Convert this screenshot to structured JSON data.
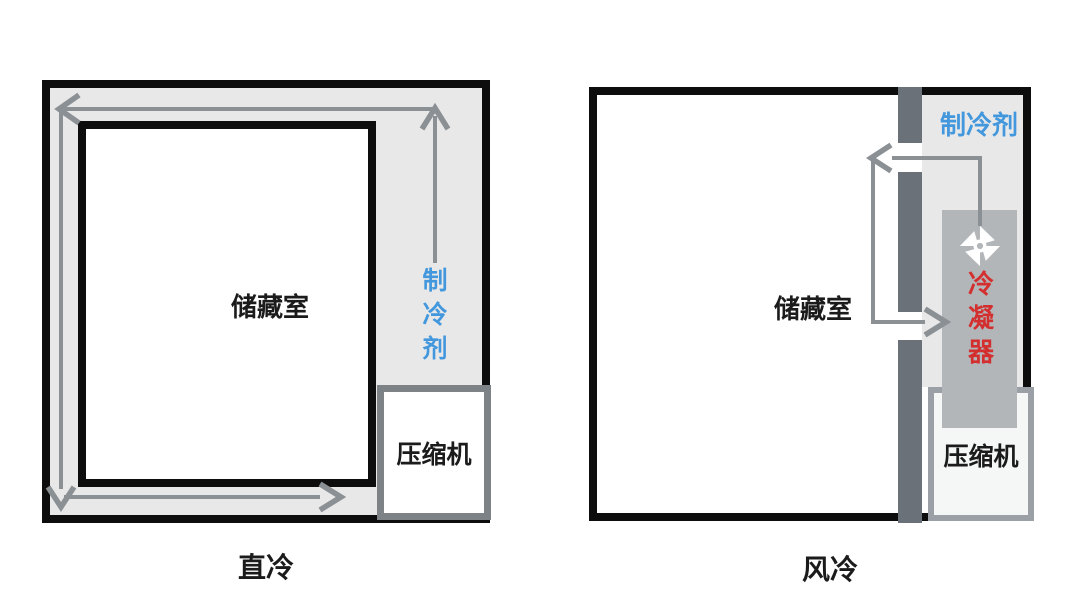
{
  "figures": {
    "direct": {
      "caption": "直冷",
      "storage_room_label": "储藏室",
      "refrigerant_label": "制冷剂",
      "compressor_label": "压缩机"
    },
    "air": {
      "caption": "风冷",
      "storage_room_label": "储藏室",
      "refrigerant_label": "制冷剂",
      "condenser_label": "冷凝器",
      "compressor_label": "压缩机",
      "fan_icon": "pinwheel-fan-icon"
    }
  },
  "colors": {
    "background": "#ffffff",
    "cabinet_border": "#0d0d0d",
    "cavity_fill": "#e8e8e9",
    "arrow_gray": "#8b9094",
    "partition_gray": "#6b7178",
    "condenser_fill": "#b3b6b9",
    "compressor_border_left": "#7d8286",
    "compressor_border_right": "#9aa0a5",
    "refrigerant_text_blue": "#4397dc",
    "condenser_text_red": "#d32f2f",
    "label_text": "#1b1b1b"
  }
}
